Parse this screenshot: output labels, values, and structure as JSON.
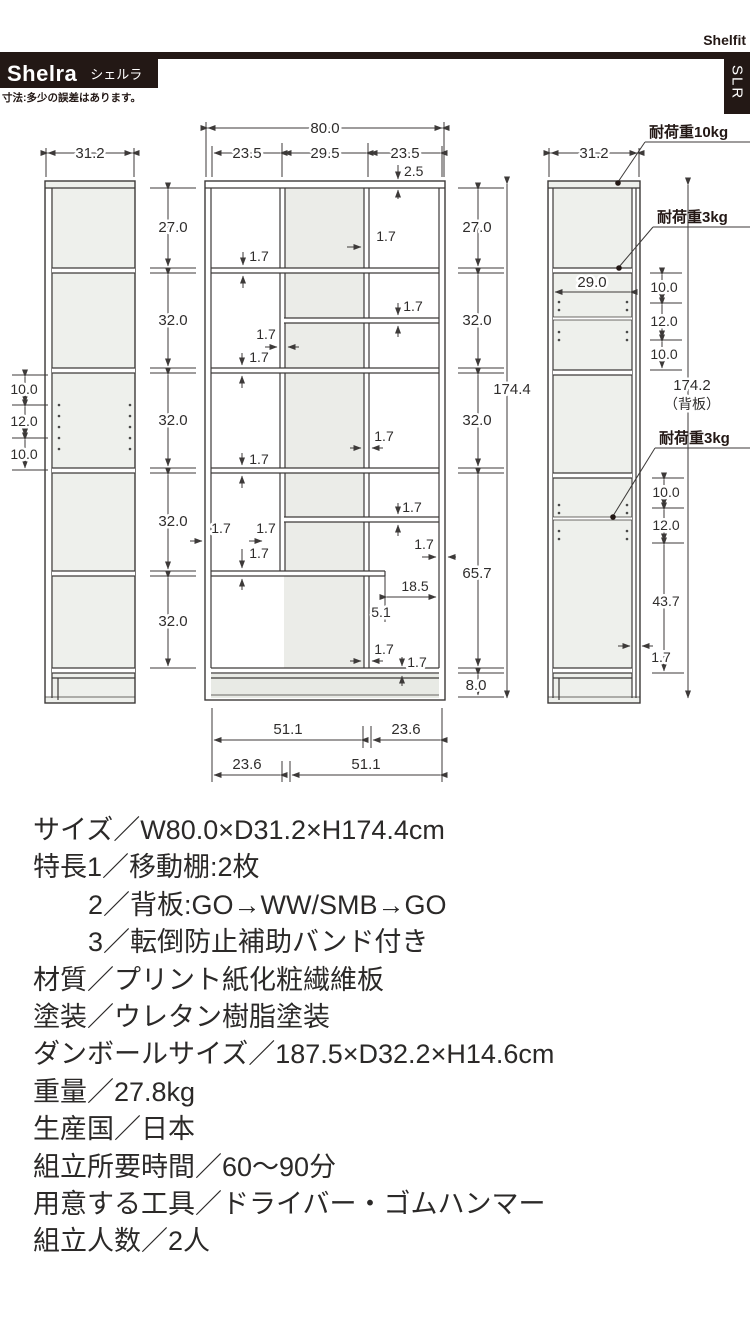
{
  "header": {
    "series": "Shelfit",
    "brand": "Shelra",
    "brand_kana": "シェルラ",
    "side_tab": "SLR",
    "tolerance_note": "寸法:多少の誤差はあります。"
  },
  "diagram": {
    "t17": "1.7",
    "side_left": {
      "width": "31.2",
      "hole_pitch": [
        "10.0",
        "12.0",
        "10.0"
      ]
    },
    "front": {
      "total_width": "80.0",
      "col_widths": [
        "23.5",
        "29.5",
        "23.5"
      ],
      "top_thickness": "2.5",
      "left_chain": [
        "27.0",
        "32.0",
        "32.0",
        "32.0",
        "32.0"
      ],
      "right_chain": [
        "27.0",
        "32.0",
        "32.0",
        "65.7",
        "8.0"
      ],
      "total_height": "174.4",
      "shelf_right_width": "18.5",
      "shelf_overhang": "5.1",
      "bottom_chain_upper": [
        "51.1",
        "23.6"
      ],
      "bottom_chain_lower": [
        "23.6",
        "51.1"
      ]
    },
    "side_right": {
      "width": "31.2",
      "inner_depth": "29.0",
      "load_top": "耐荷重10kg",
      "load_shelf1": "耐荷重3kg",
      "load_shelf2": "耐荷重3kg",
      "upper_pitch": [
        "10.0",
        "12.0",
        "10.0"
      ],
      "lower_pitch": [
        "10.0",
        "12.0",
        "43.7"
      ],
      "wall_thickness": "1.7",
      "back_height": "174.2",
      "back_note": "（背板）"
    }
  },
  "specs": {
    "lines": [
      "サイズ／W80.0×D31.2×H174.4cm",
      "特長1／移動棚:2枚",
      "2／背板:GO→WW/SMB→GO",
      "3／転倒防止補助バンド付き",
      "材質／プリント紙化粧繊維板",
      "塗装／ウレタン樹脂塗装",
      "ダンボールサイズ／187.5×D32.2×H14.6cm",
      "重量／27.8kg",
      "生産国／日本",
      "組立所要時間／60〜90分",
      "用意する工具／ドライバー・ゴムハンマー",
      "組立人数／2人"
    ]
  }
}
